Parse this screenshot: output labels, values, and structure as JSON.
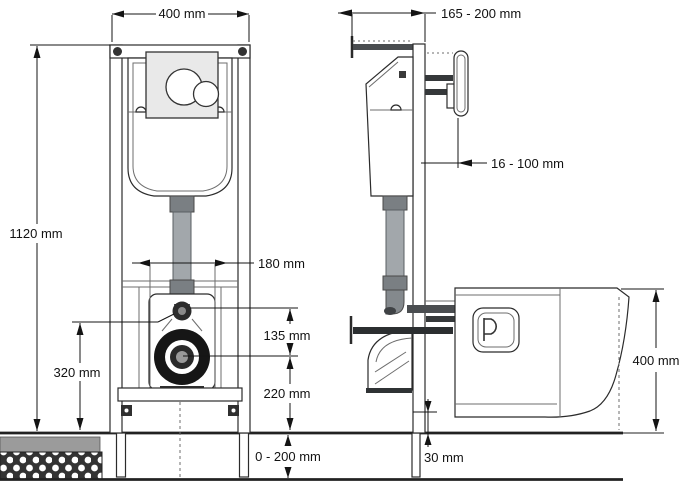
{
  "colors": {
    "line": "#2b2b2b",
    "dim": "#141414",
    "pipe": "#a2a7ab",
    "pipe_dark": "#7a7f83",
    "fitting": "#4a4d50",
    "plate": "#e9e9e9",
    "floor_dark": "#333333",
    "floor_gray": "#9b9b9b"
  },
  "front_view": {
    "dims": {
      "frame_width": "400 mm",
      "frame_height": "1120 mm",
      "bolt_spacing": "180 mm",
      "inlet_to_outlet": "135 mm",
      "outlet_to_floor": "220 mm",
      "inlet_above_floor": "320 mm",
      "floor_buildup": "0 - 200 mm"
    }
  },
  "side_view": {
    "dims": {
      "frame_depth": "165 - 200 mm",
      "actuator_adjust": "16 - 100 mm",
      "bowl_top_height": "400 mm",
      "bowl_floor_clearance": "30 mm"
    }
  }
}
